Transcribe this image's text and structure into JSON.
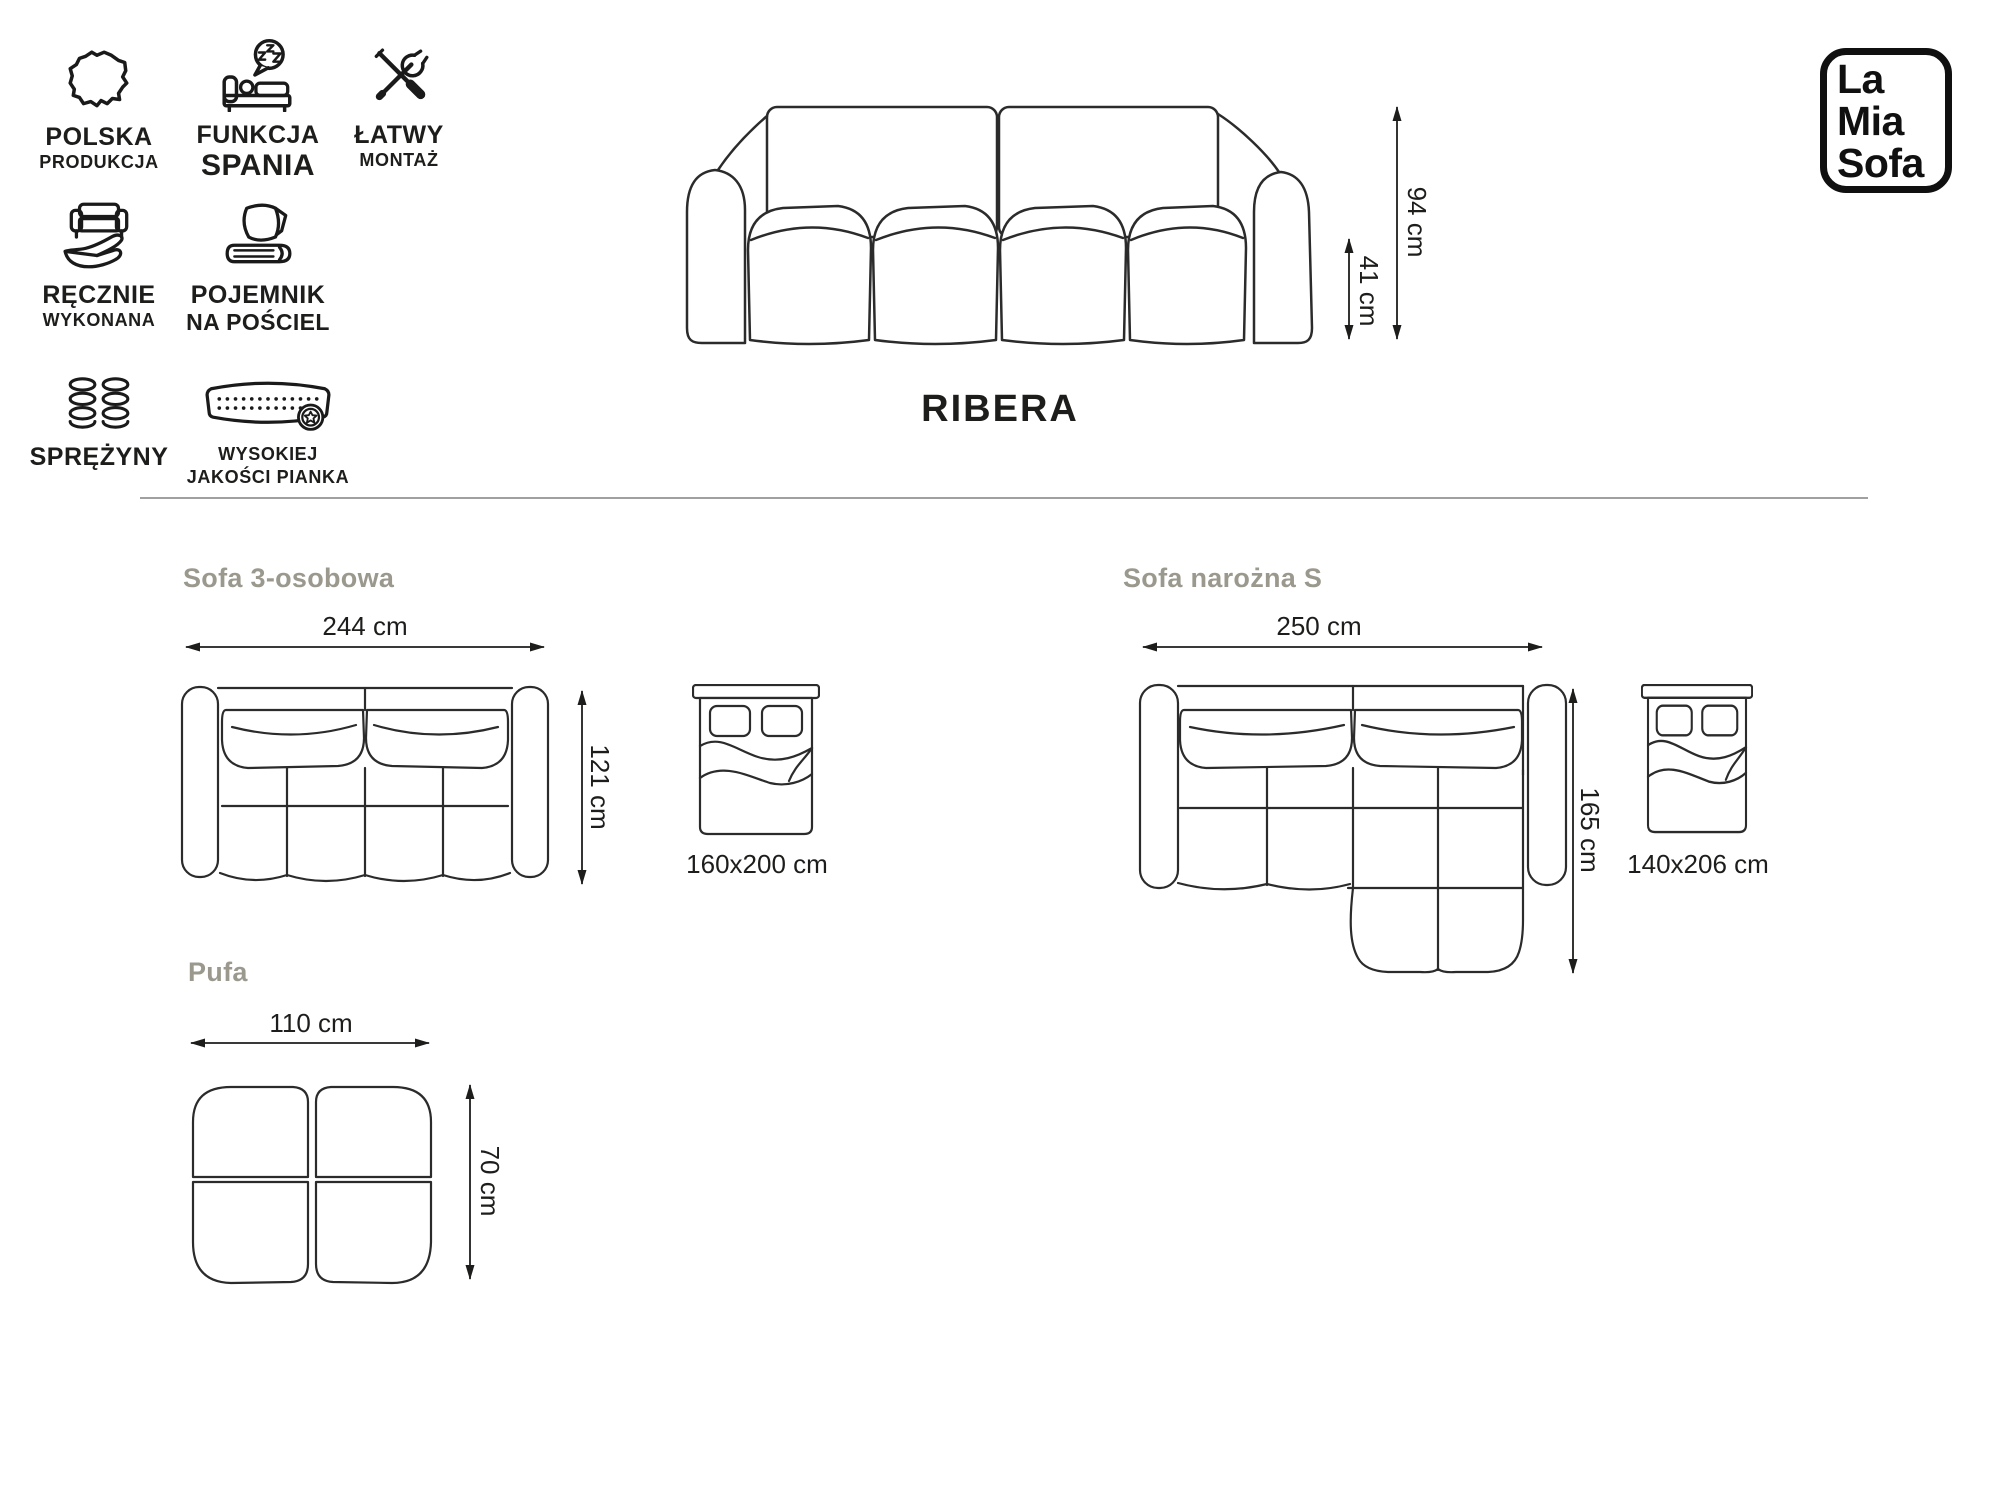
{
  "colors": {
    "background": "#ffffff",
    "line_art": "#2b2b2b",
    "text": "#1d1d1b",
    "section_label": "#9b998e",
    "divider": "#a0a0a0",
    "logo": "#101010"
  },
  "brand": {
    "line1": "La",
    "line2": "Mia",
    "line3": "Sofa"
  },
  "product": {
    "title": "RIBERA",
    "front_height": "94 cm",
    "front_seat_height": "41 cm"
  },
  "features": [
    {
      "name": "polska-produkcja",
      "icon": "poland-map-icon",
      "line1": "POLSKA",
      "line2": "PRODUKCJA"
    },
    {
      "name": "funkcja-spania",
      "icon": "sleep-function-icon",
      "line1": "FUNKCJA",
      "line2": "SPANIA"
    },
    {
      "name": "latwy-montaz",
      "icon": "tools-icon",
      "line1": "ŁATWY",
      "line2": "MONTAŻ"
    },
    {
      "name": "recznie-wykonana",
      "icon": "hand-sofa-icon",
      "line1": "RĘCZNIE",
      "line2": "WYKONANA"
    },
    {
      "name": "pojemnik-na-posciel",
      "icon": "bedding-icon",
      "line1": "POJEMNIK",
      "line2": "NA POŚCIEL"
    },
    {
      "name": "sprezyny",
      "icon": "springs-icon",
      "line1": "SPRĘŻYNY",
      "line2": ""
    },
    {
      "name": "wysokiej-jakosci-pianka",
      "icon": "foam-icon",
      "line1": "WYSOKIEJ",
      "line2": "JAKOŚCI PIANKA"
    }
  ],
  "variants": [
    {
      "label": "Sofa 3-osobowa",
      "width": "244 cm",
      "depth": "121 cm",
      "bed": "160x200 cm"
    },
    {
      "label": "Sofa narożna S",
      "width": "250 cm",
      "depth": "165 cm",
      "bed": "140x206 cm"
    },
    {
      "label": "Pufa",
      "width": "110 cm",
      "depth": "70 cm"
    }
  ]
}
